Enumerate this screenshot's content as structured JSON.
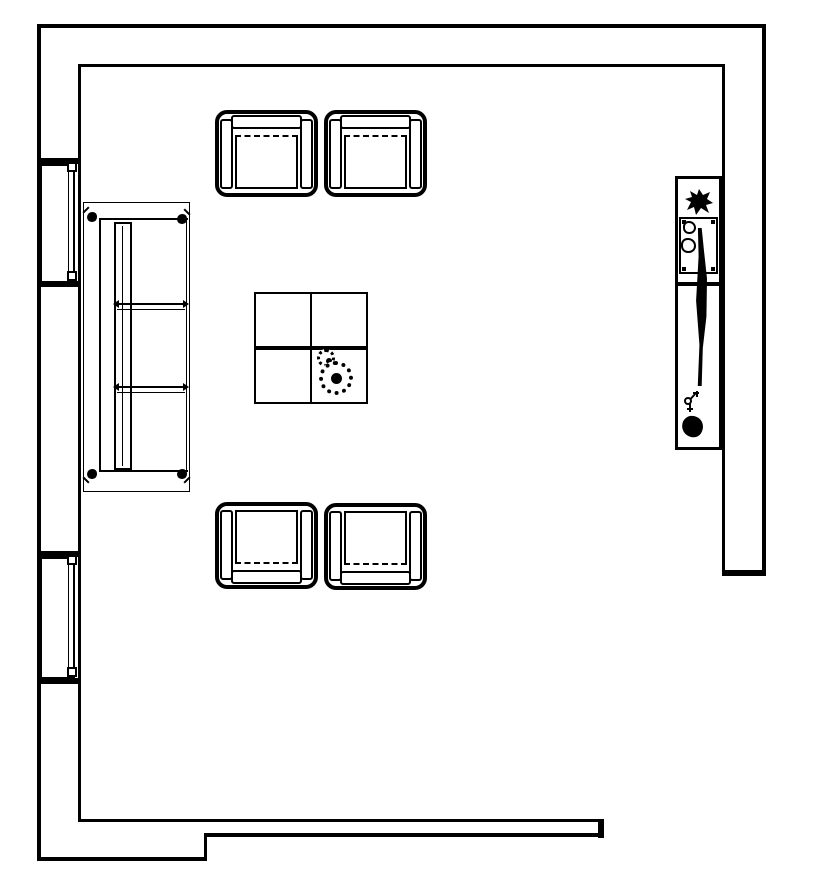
{
  "canvas": {
    "background": "#ffffff",
    "ink": "#000000",
    "description": "Black-and-white architectural floor plan of a living room"
  },
  "floorplan": {
    "title": "Living room floor plan",
    "room": {
      "label": "Living room",
      "opening_note": "Wall opening at bottom-right corner"
    },
    "windows": [
      {
        "label": "Window (upper left wall)"
      },
      {
        "label": "Window (lower left wall)"
      }
    ],
    "furniture": [
      {
        "id": "sofa",
        "label": "Three-seat sofa"
      },
      {
        "id": "armchair-top-left",
        "label": "Armchair (top left)"
      },
      {
        "id": "armchair-top-right",
        "label": "Armchair (top right)"
      },
      {
        "id": "armchair-bottom-left",
        "label": "Armchair (bottom left)"
      },
      {
        "id": "armchair-bottom-right",
        "label": "Armchair (bottom right)"
      },
      {
        "id": "coffee-table",
        "label": "Square coffee table with two round dishes"
      },
      {
        "id": "console",
        "label": "Console counter with plant, basin and decor"
      }
    ],
    "icons": [
      {
        "name": "plant-icon",
        "meaning": "potted plant splat symbol"
      },
      {
        "name": "basin-icon",
        "meaning": "basin with two round knobs"
      },
      {
        "name": "dish-icon",
        "meaning": "round scalloped dish"
      },
      {
        "name": "faucet-icon",
        "meaning": "small tap glyph"
      },
      {
        "name": "decor-blob-icon",
        "meaning": "round dark decor object"
      }
    ]
  }
}
